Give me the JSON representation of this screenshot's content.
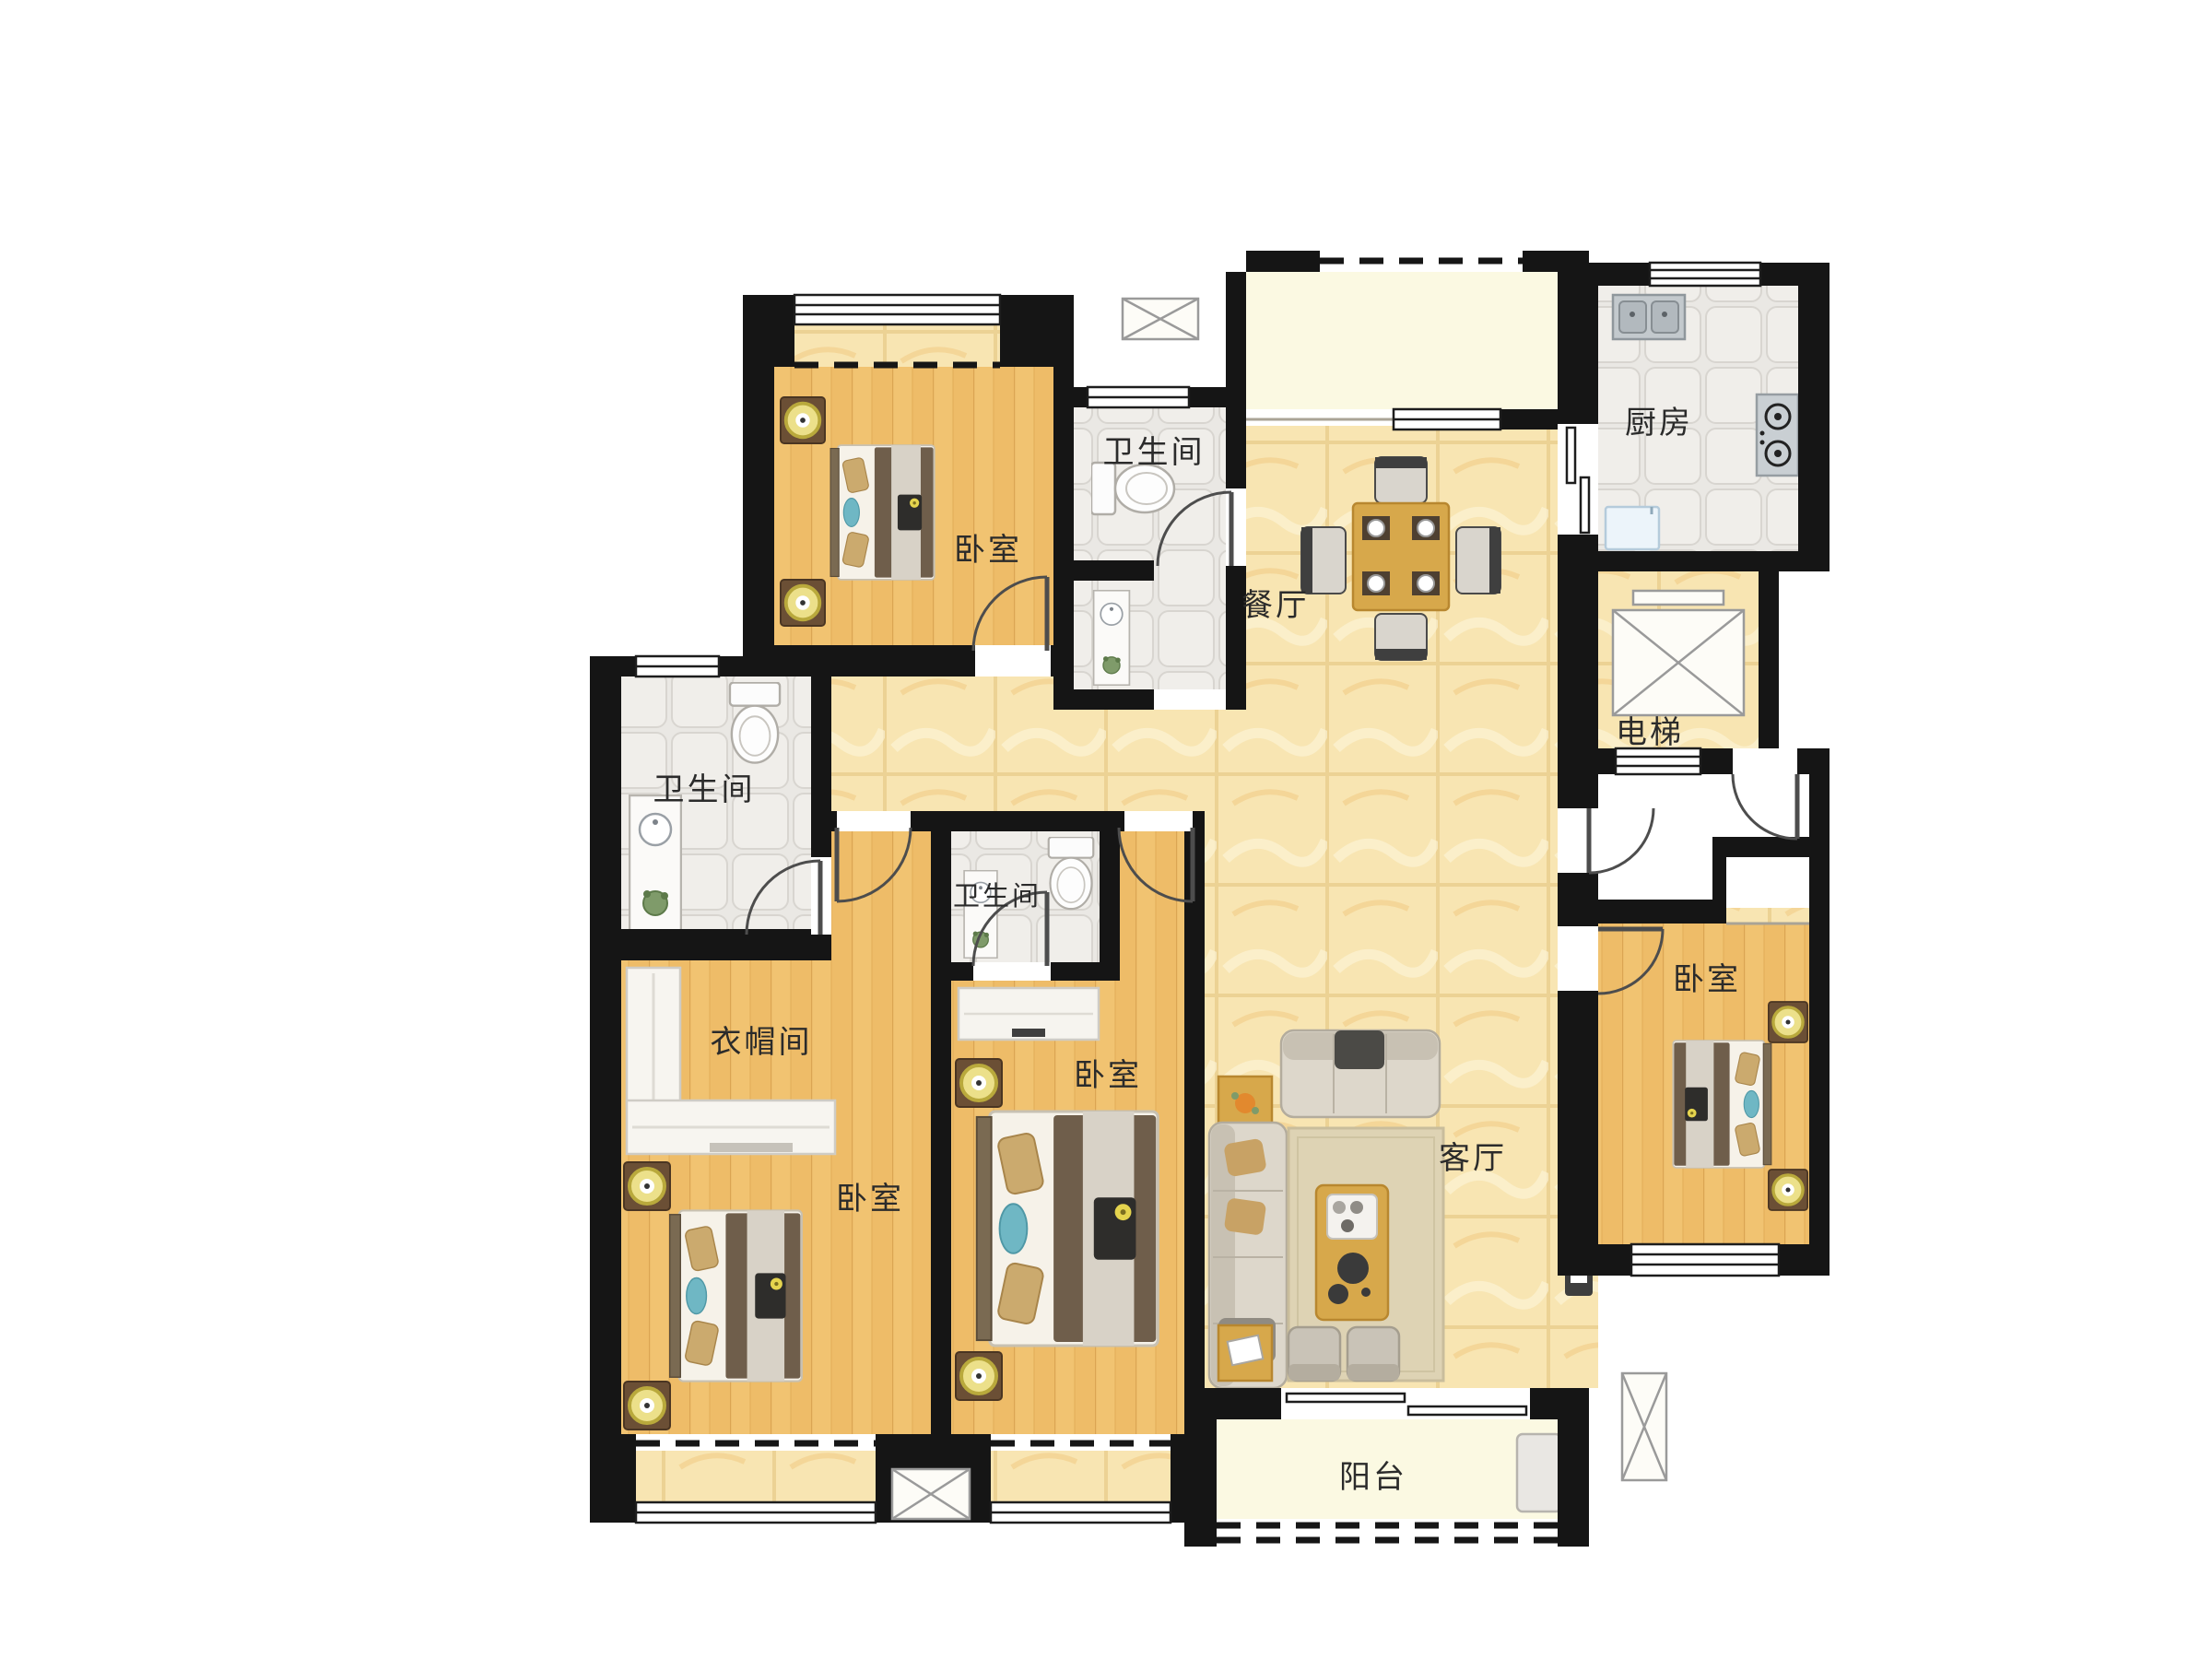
{
  "page": {
    "type": "apartment-floor-plan",
    "background": "#ffffff"
  },
  "colors": {
    "wall": "#151515",
    "wood_floor": "#eebc68",
    "marble_floor": "#f8e5b2",
    "tile_floor": "#eae8e4",
    "cream_floor": "#fbf9e2",
    "lamp_accent": "#e8d84a",
    "pillow_teal": "#6fb7c4",
    "furniture_wood": "#d7a84b",
    "blanket_brown": "#6f5e4b"
  },
  "rooms": {
    "bedroom_top_left": {
      "label": "卧室"
    },
    "bathroom_top": {
      "label": "卫生间"
    },
    "kitchen": {
      "label": "厨房"
    },
    "dining_room": {
      "label": "餐厅"
    },
    "elevator": {
      "label": "电梯"
    },
    "bathroom_left": {
      "label": "卫生间"
    },
    "bathroom_middle": {
      "label": "卫生间"
    },
    "cloakroom": {
      "label": "衣帽间"
    },
    "bedroom_bottom_left": {
      "label": "卧室"
    },
    "bedroom_bottom_middle": {
      "label": "卧室"
    },
    "bedroom_right": {
      "label": "卧室"
    },
    "living_room": {
      "label": "客厅"
    },
    "balcony": {
      "label": "阳台"
    }
  },
  "fixtures": [
    "double-bed-icon",
    "nightstand-lamp-icon",
    "toilet-icon",
    "vanity-sink-icon",
    "kitchen-sink-icon",
    "gas-stove-icon",
    "refrigerator-icon",
    "dining-table-icon",
    "sofa-group-icon",
    "coffee-table-icon",
    "tv-board-icon",
    "wardrobe-icon",
    "dresser-icon",
    "elevator-shaft-icon",
    "window-icon",
    "door-swing-icon",
    "bay-window-icon",
    "balcony-cabinet-icon",
    "shaft-x-icon"
  ]
}
